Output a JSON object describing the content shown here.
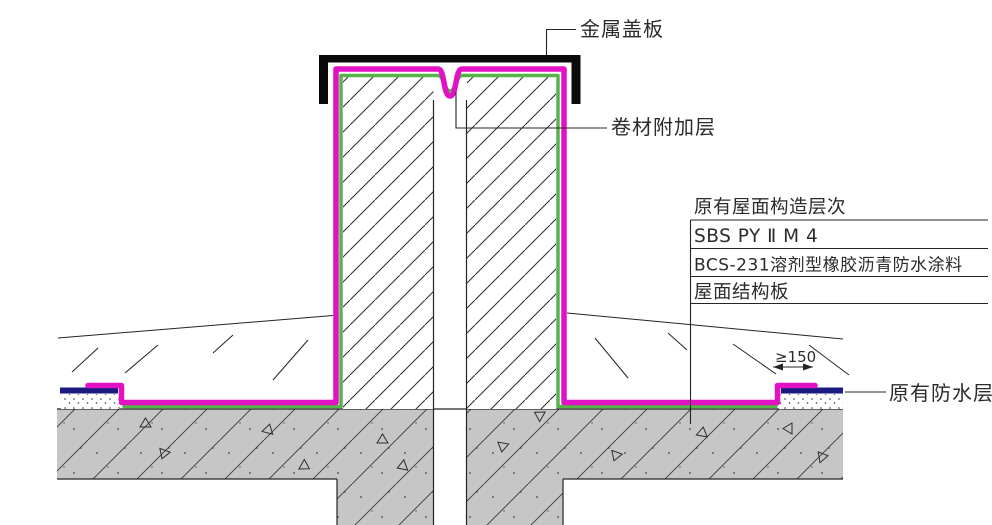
{
  "labels": {
    "metal_cover_plate": "金属盖板",
    "membrane_additional_layer": "卷材附加层",
    "existing_waterproof_layer": "原有防水层"
  },
  "dimension": {
    "membrane_overlap": "≥150"
  },
  "roof_layers_table": {
    "title": "原有屋面构造层次",
    "rows": [
      "SBS PY Ⅱ M 4",
      "BCS-231溶剂型橡胶沥青防水涂料",
      "屋面结构板"
    ]
  },
  "colors": {
    "membrane_magenta": "#E311C6",
    "coating_green": "#55B549",
    "existing_waterproof_navy": "#1A1A80",
    "concrete_gray": "#C6C6C6",
    "line_dark": "#242424",
    "cover_plate_black": "#0A0A0A",
    "background": "#FFFFFF"
  }
}
